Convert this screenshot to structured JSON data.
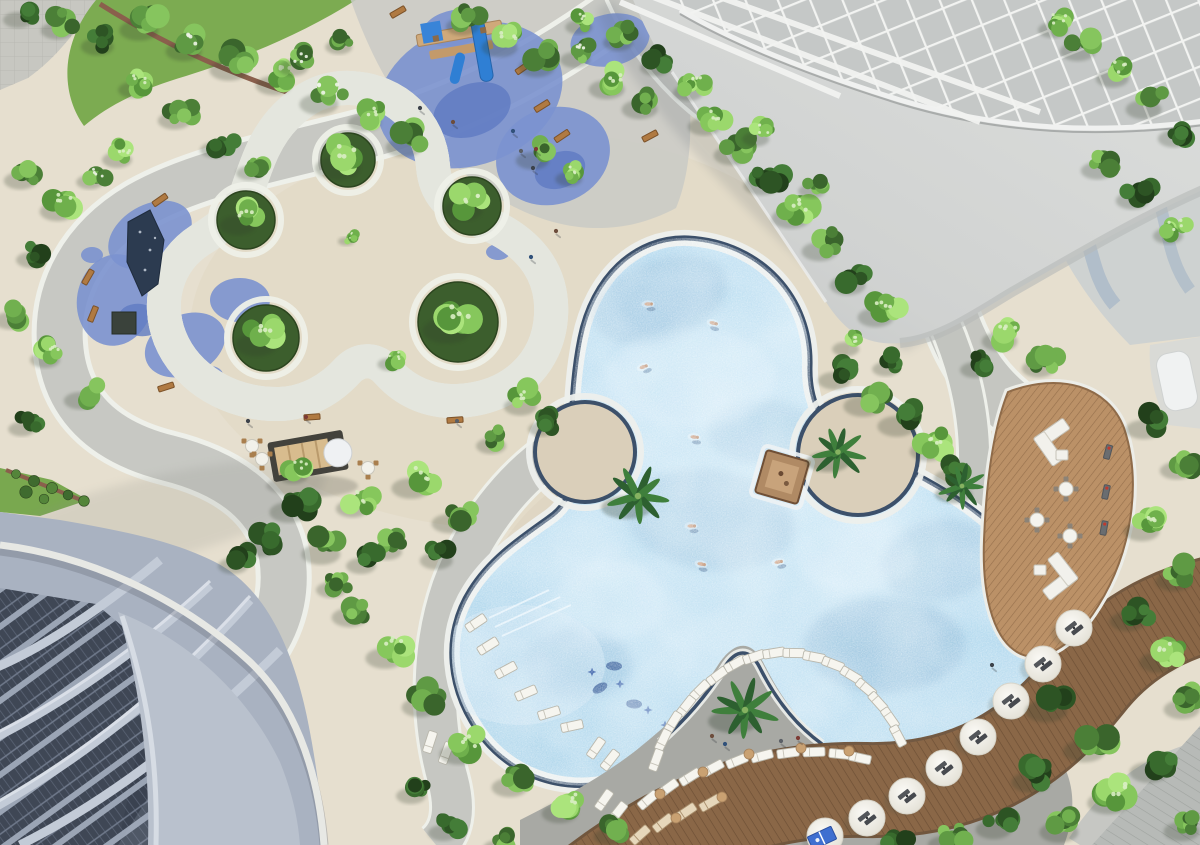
{
  "scene": {
    "kind": "aerial-3d-architectural-render",
    "subject": "resort amenity deck: free-form trefoil pool, trefoil lawn, playground, wooden decks, towers"
  },
  "palette": {
    "deck": "#e6dfcf",
    "deckWarm": "#dacfb8",
    "pathGrey": "#c7c8c3",
    "pathWhite": "#eef0ea",
    "rubberBlue": "#7b92cf",
    "rubberBlueDark": "#5f7ac2",
    "lawnDark": "#4a7031",
    "lawnBright": "#7cab51",
    "water": "#aed7ec",
    "waterDeep": "#6f9fc4",
    "waterLight": "#dceffa",
    "poolRim": "#3c506a",
    "coping": "#edefec",
    "woodDeck": "#b98f67",
    "woodBand": "#8a6747",
    "roofGrey": "#d3d5d3",
    "lattice": "#f2f3f1",
    "facade": "#a9b2c1",
    "facadeSlab": "#b9c1cd",
    "windowDark": "#39414f",
    "hedgeDark": "#2e5124",
    "furnitureWhite": "#f6f5ef",
    "benchWood": "#b07a42",
    "sand": "#dacfba"
  },
  "layers": {
    "rubber": [
      [
        470,
        95,
        95,
        70,
        -20
      ],
      [
        553,
        156,
        58,
        48,
        -20
      ],
      [
        455,
        28,
        32,
        18,
        -10
      ],
      [
        610,
        40,
        40,
        26,
        -12
      ],
      [
        150,
        235,
        45,
        30,
        -30
      ],
      [
        115,
        300,
        38,
        46,
        10
      ],
      [
        185,
        345,
        42,
        30,
        -25
      ],
      [
        240,
        300,
        30,
        22,
        0
      ],
      [
        210,
        375,
        13,
        9,
        0
      ],
      [
        92,
        255,
        11,
        8,
        0
      ],
      [
        498,
        252,
        12,
        8,
        0
      ]
    ],
    "rubberDark": [
      [
        472,
        110,
        40,
        26,
        -20
      ],
      [
        560,
        170,
        26,
        18,
        -20
      ],
      [
        140,
        320,
        22,
        16,
        10
      ]
    ],
    "darkPatches": [
      [
        660,
        300,
        70,
        40,
        -20,
        0.28
      ],
      [
        710,
        520,
        85,
        50,
        8,
        0.22
      ],
      [
        885,
        645,
        80,
        48,
        0,
        0.3
      ],
      [
        578,
        664,
        55,
        35,
        0,
        0.22
      ],
      [
        762,
        432,
        55,
        32,
        0,
        0.18
      ],
      [
        940,
        560,
        60,
        40,
        -10,
        0.25
      ]
    ],
    "lightPatches": [
      [
        690,
        378,
        85,
        50,
        0,
        0.4
      ],
      [
        855,
        555,
        60,
        36,
        0,
        0.3
      ],
      [
        610,
        600,
        55,
        40,
        0,
        0.35
      ]
    ],
    "planters": [
      [
        348,
        160,
        27
      ],
      [
        246,
        220,
        29
      ],
      [
        266,
        338,
        33
      ],
      [
        458,
        322,
        40
      ],
      [
        472,
        206,
        29
      ]
    ],
    "islands": [
      [
        585,
        452,
        50
      ],
      [
        858,
        455,
        60
      ]
    ],
    "trees": [
      [
        25,
        12,
        1,
        2
      ],
      [
        65,
        22,
        1.1,
        0
      ],
      [
        105,
        38,
        1.1,
        2
      ],
      [
        148,
        20,
        1.3,
        0
      ],
      [
        192,
        42,
        1.2,
        3
      ],
      [
        238,
        60,
        1.3,
        0
      ],
      [
        282,
        76,
        1.2,
        1
      ],
      [
        328,
        94,
        1.3,
        3
      ],
      [
        372,
        114,
        1.1,
        1
      ],
      [
        412,
        138,
        1.2,
        0
      ],
      [
        140,
        82,
        1,
        1
      ],
      [
        182,
        112,
        1.1,
        0
      ],
      [
        222,
        142,
        1,
        2
      ],
      [
        256,
        166,
        0.9,
        0
      ],
      [
        300,
        60,
        1,
        3
      ],
      [
        345,
        40,
        0.9,
        0
      ],
      [
        28,
        172,
        1.1,
        0
      ],
      [
        66,
        202,
        1.2,
        1
      ],
      [
        38,
        252,
        1,
        2
      ],
      [
        18,
        312,
        1.1,
        0
      ],
      [
        52,
        352,
        1,
        1
      ],
      [
        88,
        392,
        1.1,
        0
      ],
      [
        28,
        422,
        0.9,
        2
      ],
      [
        124,
        152,
        1,
        1
      ],
      [
        96,
        175,
        0.9,
        3
      ],
      [
        470,
        18,
        1.1,
        0
      ],
      [
        508,
        38,
        1.2,
        1
      ],
      [
        545,
        58,
        1.2,
        0
      ],
      [
        582,
        52,
        1,
        3
      ],
      [
        615,
        80,
        1.2,
        1
      ],
      [
        648,
        100,
        1.2,
        0
      ],
      [
        585,
        20,
        0.9,
        1
      ],
      [
        625,
        35,
        1,
        0
      ],
      [
        662,
        60,
        1,
        2
      ],
      [
        695,
        85,
        1,
        1
      ],
      [
        540,
        152,
        1.1,
        0
      ],
      [
        575,
        172,
        0.9,
        1
      ],
      [
        712,
        118,
        1.1,
        1
      ],
      [
        740,
        146,
        1.2,
        0
      ],
      [
        770,
        176,
        1.2,
        2
      ],
      [
        800,
        208,
        1.3,
        1
      ],
      [
        828,
        242,
        1.2,
        0
      ],
      [
        856,
        276,
        1.2,
        2
      ],
      [
        884,
        308,
        1.2,
        1
      ],
      [
        762,
        132,
        0.9,
        1
      ],
      [
        818,
        184,
        0.9,
        0
      ],
      [
        842,
        372,
        1.1,
        2
      ],
      [
        872,
        396,
        1.3,
        0
      ],
      [
        906,
        416,
        1.3,
        2
      ],
      [
        936,
        442,
        1.2,
        1
      ],
      [
        956,
        470,
        1,
        2
      ],
      [
        852,
        342,
        0.9,
        1
      ],
      [
        892,
        362,
        0.9,
        2
      ],
      [
        1086,
        42,
        1.2,
        0
      ],
      [
        1120,
        70,
        1.1,
        1
      ],
      [
        1152,
        100,
        1.2,
        0
      ],
      [
        1182,
        130,
        1.1,
        2
      ],
      [
        1105,
        162,
        1.1,
        0
      ],
      [
        1140,
        192,
        1.1,
        2
      ],
      [
        1060,
        22,
        1,
        1
      ],
      [
        1175,
        228,
        1,
        1
      ],
      [
        1008,
        332,
        1.2,
        1
      ],
      [
        1046,
        360,
        1.1,
        0
      ],
      [
        982,
        362,
        1,
        2
      ],
      [
        1152,
        420,
        1.2,
        2
      ],
      [
        1184,
        462,
        1.1,
        0
      ],
      [
        1150,
        522,
        1.2,
        1
      ],
      [
        1182,
        572,
        1.2,
        0
      ],
      [
        1136,
        612,
        1.2,
        2
      ],
      [
        1168,
        652,
        1.3,
        1
      ],
      [
        1056,
        700,
        1.4,
        2
      ],
      [
        1094,
        740,
        1.4,
        0
      ],
      [
        1040,
        772,
        1.3,
        2
      ],
      [
        1118,
        792,
        1.4,
        1
      ],
      [
        1068,
        822,
        1.3,
        0
      ],
      [
        1002,
        820,
        1.2,
        2
      ],
      [
        952,
        836,
        1.1,
        0
      ],
      [
        1158,
        762,
        1.3,
        2
      ],
      [
        1190,
        822,
        1.2,
        0
      ],
      [
        898,
        840,
        1,
        2
      ],
      [
        1190,
        700,
        1.2,
        0
      ],
      [
        348,
        156,
        1.5,
        1
      ],
      [
        246,
        216,
        1.2,
        1
      ],
      [
        266,
        334,
        1.4,
        1
      ],
      [
        458,
        318,
        1.6,
        1
      ],
      [
        472,
        200,
        1.3,
        1
      ],
      [
        395,
        358,
        0.8,
        1
      ],
      [
        350,
        237,
        0.55,
        1
      ],
      [
        298,
        502,
        1.3,
        2
      ],
      [
        268,
        538,
        1.2,
        2
      ],
      [
        330,
        544,
        1.3,
        0
      ],
      [
        360,
        500,
        1.1,
        1
      ],
      [
        240,
        558,
        1,
        2
      ],
      [
        394,
        544,
        1,
        0
      ],
      [
        300,
        468,
        1,
        1
      ],
      [
        420,
        478,
        1.3,
        1
      ],
      [
        458,
        514,
        1.2,
        0
      ],
      [
        444,
        552,
        1.1,
        2
      ],
      [
        528,
        398,
        1.1,
        1
      ],
      [
        498,
        438,
        1,
        0
      ],
      [
        548,
        422,
        0.9,
        2
      ],
      [
        358,
        608,
        1.2,
        0
      ],
      [
        394,
        648,
        1.3,
        1
      ],
      [
        428,
        698,
        1.2,
        0
      ],
      [
        468,
        744,
        1.3,
        1
      ],
      [
        518,
        778,
        1.2,
        0
      ],
      [
        568,
        804,
        1.2,
        1
      ],
      [
        618,
        828,
        1.1,
        0
      ],
      [
        418,
        788,
        1,
        2
      ],
      [
        368,
        558,
        1,
        2
      ],
      [
        338,
        582,
        1,
        0
      ],
      [
        450,
        825,
        1,
        2
      ],
      [
        505,
        840,
        1,
        0
      ]
    ],
    "palms": [
      [
        638,
        496,
        1.15
      ],
      [
        838,
        452,
        1.0
      ],
      [
        745,
        710,
        1.15
      ],
      [
        962,
        486,
        0.85
      ]
    ],
    "loungers": [
      [
        488,
        646,
        -32
      ],
      [
        506,
        670,
        -28
      ],
      [
        526,
        693,
        -23
      ],
      [
        549,
        713,
        -17
      ],
      [
        476,
        623,
        -34
      ],
      [
        572,
        726,
        -12
      ],
      [
        700,
        690,
        -45
      ],
      [
        717,
        676,
        -37
      ],
      [
        735,
        664,
        -29
      ],
      [
        754,
        657,
        -19
      ],
      [
        774,
        653,
        -9
      ],
      [
        794,
        653,
        1
      ],
      [
        814,
        657,
        11
      ],
      [
        833,
        664,
        21
      ],
      [
        851,
        675,
        31
      ],
      [
        866,
        688,
        40
      ],
      [
        878,
        702,
        48
      ],
      [
        890,
        718,
        55
      ],
      [
        898,
        736,
        62
      ],
      [
        686,
        706,
        -52
      ],
      [
        673,
        722,
        -58
      ],
      [
        663,
        740,
        -64
      ],
      [
        656,
        760,
        -70
      ],
      [
        648,
        800,
        -40
      ],
      [
        668,
        788,
        -36
      ],
      [
        690,
        777,
        -32
      ],
      [
        713,
        768,
        -28
      ],
      [
        737,
        761,
        -22
      ],
      [
        762,
        756,
        -15
      ],
      [
        788,
        753,
        -8
      ],
      [
        814,
        752,
        -2
      ],
      [
        840,
        754,
        6
      ],
      [
        860,
        758,
        12
      ],
      [
        430,
        742,
        -72
      ],
      [
        446,
        753,
        -70
      ],
      [
        596,
        748,
        -55
      ],
      [
        610,
        760,
        -52
      ],
      [
        604,
        800,
        -55
      ],
      [
        618,
        812,
        -52
      ]
    ],
    "loungersWood": [
      [
        640,
        835,
        -42
      ],
      [
        663,
        823,
        -38
      ],
      [
        686,
        812,
        -34
      ],
      [
        710,
        803,
        -30
      ]
    ],
    "umbrellas": [
      [
        1074,
        628
      ],
      [
        1043,
        664
      ],
      [
        1011,
        701
      ],
      [
        978,
        737
      ],
      [
        944,
        768
      ],
      [
        907,
        796
      ],
      [
        867,
        818
      ],
      [
        825,
        836
      ]
    ],
    "floats": [
      [
        600,
        688
      ],
      [
        634,
        704
      ],
      [
        614,
        666
      ]
    ],
    "stars": [
      [
        620,
        684
      ],
      [
        648,
        710
      ],
      [
        592,
        672
      ],
      [
        665,
        725
      ]
    ],
    "swimmers": [
      [
        713,
        323,
        15
      ],
      [
        643,
        367,
        -20
      ],
      [
        694,
        437,
        5
      ],
      [
        691,
        526,
        0
      ],
      [
        701,
        564,
        10
      ],
      [
        778,
        562,
        -10
      ],
      [
        648,
        304,
        0
      ]
    ],
    "people": [
      [
        420,
        108
      ],
      [
        453,
        122
      ],
      [
        513,
        131
      ],
      [
        521,
        151
      ],
      [
        536,
        149
      ],
      [
        533,
        168
      ],
      [
        556,
        231
      ],
      [
        531,
        257
      ],
      [
        457,
        421
      ],
      [
        306,
        417
      ],
      [
        248,
        421
      ],
      [
        712,
        736
      ],
      [
        725,
        744
      ],
      [
        781,
        741
      ],
      [
        798,
        738
      ],
      [
        992,
        665
      ]
    ],
    "tables4": [
      [
        1066,
        489
      ],
      [
        1037,
        520
      ],
      [
        1070,
        536
      ]
    ],
    "tablesPav": [
      [
        252,
        446
      ],
      [
        262,
        459
      ],
      [
        368,
        468
      ]
    ],
    "parkBenches": [
      [
        398,
        12,
        -30
      ],
      [
        523,
        68,
        -35
      ],
      [
        542,
        106,
        -32
      ],
      [
        562,
        136,
        -34
      ],
      [
        650,
        136,
        -28
      ],
      [
        160,
        200,
        -35
      ],
      [
        88,
        277,
        -60
      ],
      [
        93,
        314,
        -68
      ],
      [
        166,
        387,
        -18
      ],
      [
        312,
        417,
        -4
      ],
      [
        455,
        420,
        -4
      ]
    ],
    "deckBenches": [
      [
        1108,
        452,
        -75
      ],
      [
        1106,
        492,
        -78
      ],
      [
        1104,
        528,
        -80
      ]
    ],
    "sofas": [
      [
        1052,
        434,
        -35
      ],
      [
        1060,
        584,
        142
      ]
    ],
    "ottomans": [
      [
        1062,
        455
      ],
      [
        1040,
        570
      ]
    ],
    "woodDots": [
      [
        660,
        794
      ],
      [
        703,
        772
      ],
      [
        749,
        754
      ],
      [
        801,
        748
      ],
      [
        849,
        751
      ],
      [
        676,
        818
      ],
      [
        722,
        797
      ]
    ],
    "bushes": [
      [
        16,
        474
      ],
      [
        34,
        481
      ],
      [
        52,
        488
      ],
      [
        68,
        495
      ],
      [
        84,
        501
      ],
      [
        26,
        492
      ],
      [
        44,
        499
      ]
    ],
    "tt": [
      [
        822,
        838,
        -25
      ]
    ]
  }
}
